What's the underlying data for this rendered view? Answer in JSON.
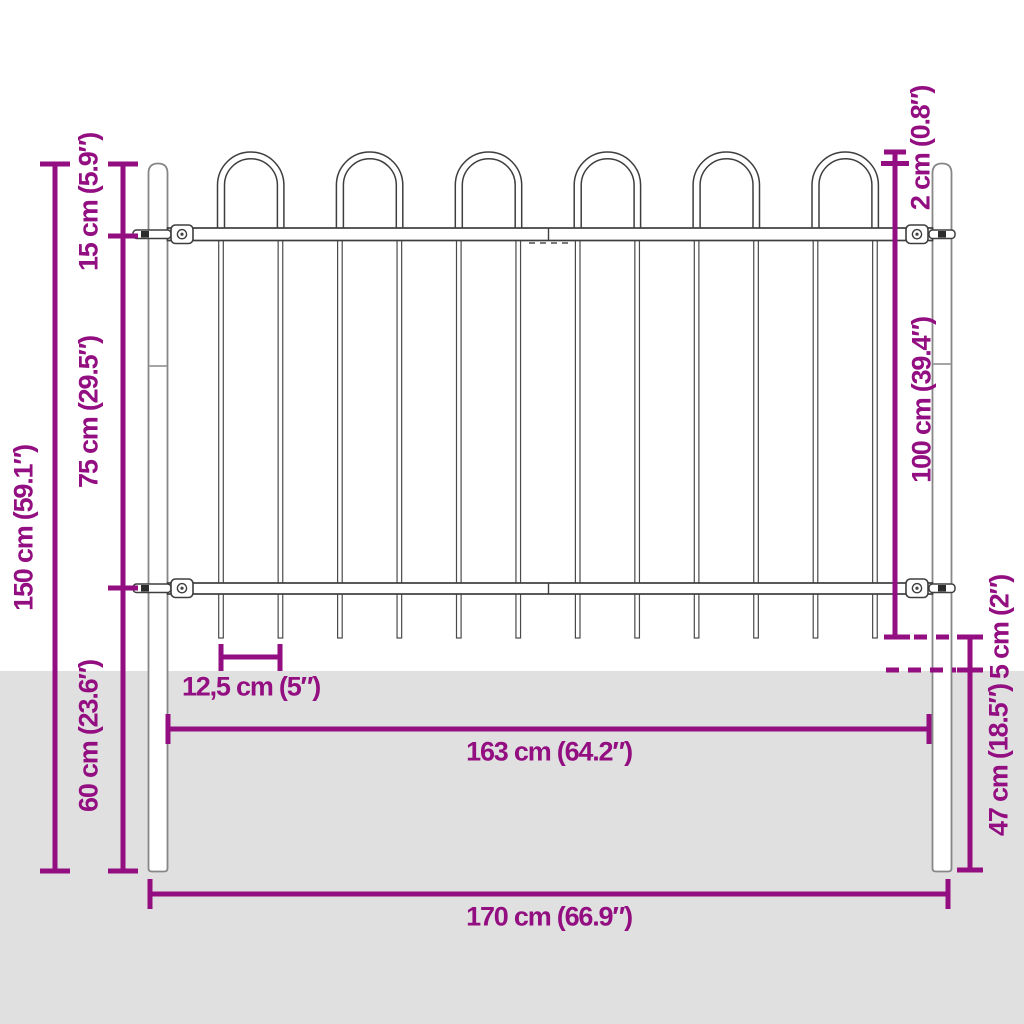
{
  "diagram": {
    "subject": "steel-fence-with-hoop-top-dimension-diagram",
    "colors": {
      "dimension_accent": "#920e81",
      "ground_shading": "#e1e0e0",
      "fence_outline": "#3e3e3e",
      "post_outline": "#878787"
    },
    "labels": {
      "total_height": "150 cm (59.1″)",
      "hoop_section_height": "15 cm (5.9″)",
      "rail_to_rail": "75 cm (29.5″)",
      "lower_section": "60 cm (23.6″)",
      "hoop_above_post": "2 cm (0.8″)",
      "panel_height": "100 cm (39.4″)",
      "ground_clearance": "5 cm (2″)",
      "post_above_ground": "47 cm (18.5″)",
      "bar_spacing": "12,5 cm (5″)",
      "panel_width": "163 cm (64.2″)",
      "total_width": "170 cm (66.9″)"
    }
  }
}
